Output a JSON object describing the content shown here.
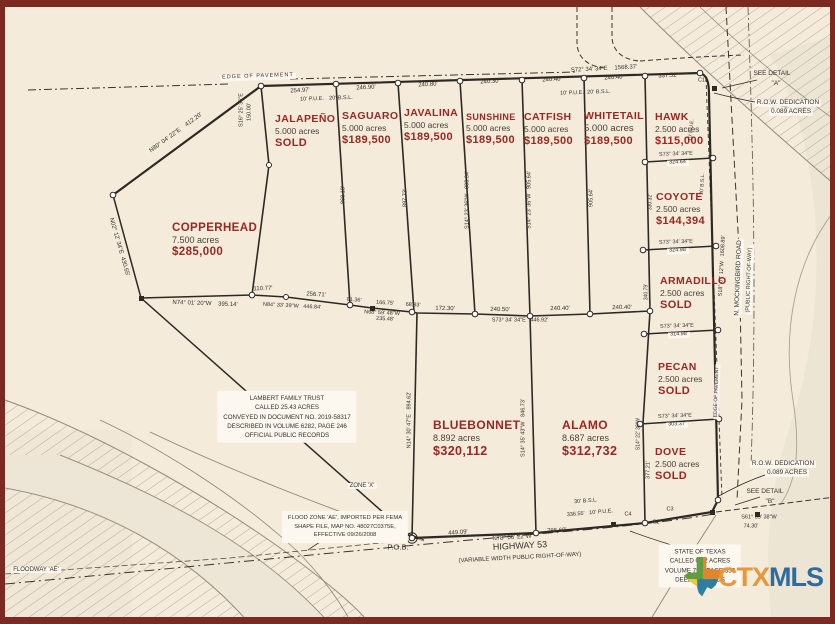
{
  "map": {
    "logo": {
      "ctx": "CTX",
      "mls": "MLS"
    },
    "colors": {
      "lot_red": "#9b2820",
      "line": "#2e2922",
      "cream": "#f4ebdb",
      "maroon_border": "#7c2a21",
      "ctx_orange": "#e8973b",
      "mls_blue": "#2f6b9d"
    },
    "lots": [
      {
        "name": "JALAPEÑO",
        "acres": "5.000 acres",
        "price": "SOLD",
        "x": 275,
        "y": 113
      },
      {
        "name": "SAGUARO",
        "acres": "5.000 acres",
        "price": "$189,500",
        "x": 342,
        "y": 110
      },
      {
        "name": "JAVALINA",
        "acres": "5.000 acres",
        "price": "$189,500",
        "x": 404,
        "y": 107
      },
      {
        "name": "SUNSHINE",
        "acres": "5.000 acres",
        "price": "$189,500",
        "x": 466,
        "y": 112,
        "ns": 9
      },
      {
        "name": "CATFISH",
        "acres": "5.000 acres",
        "price": "$189,500",
        "x": 524,
        "y": 111
      },
      {
        "name": "WHITETAIL",
        "acres": "5.000 acres",
        "price": "$189,500",
        "x": 584,
        "y": 110,
        "as": 9.5
      },
      {
        "name": "HAWK",
        "acres": "2.500 acres",
        "price": "$115,000",
        "x": 655,
        "y": 111
      },
      {
        "name": "COYOTE",
        "acres": "2.500 acres",
        "price": "$144,394",
        "x": 656,
        "y": 191
      },
      {
        "name": "ARMADILLO",
        "acres": "2.500 acres",
        "price": "SOLD",
        "x": 660,
        "y": 275
      },
      {
        "name": "PECAN",
        "acres": "2.500 acres",
        "price": "SOLD",
        "x": 658,
        "y": 361
      },
      {
        "name": "DOVE",
        "acres": "2.500 acres",
        "price": "SOLD",
        "x": 655,
        "y": 446
      },
      {
        "name": "COPPERHEAD",
        "acres": "7.500 acres",
        "price": "$285,000",
        "x": 172,
        "y": 222,
        "ns": 11.5,
        "as": 9,
        "ps": 11.5
      },
      {
        "name": "BLUEBONNET",
        "acres": "8.892 acres",
        "price": "$320,112",
        "x": 433,
        "y": 418,
        "ns": 12,
        "as": 9,
        "ps": 12.5
      },
      {
        "name": "ALAMO",
        "acres": "8.687 acres",
        "price": "$312,732",
        "x": 562,
        "y": 418,
        "ns": 12,
        "as": 9,
        "ps": 12.5
      }
    ],
    "annotations": [
      {
        "text": "EDGE OF PAVEMENT",
        "x": 258,
        "y": 77,
        "rot": -2,
        "size": 5.5,
        "bg": true,
        "ls": 1
      },
      {
        "text": "S72° 34' 34\"E    1568.37'",
        "x": 604,
        "y": 69,
        "rot": -3,
        "size": 6
      },
      {
        "text": "254.97'",
        "x": 300,
        "y": 91,
        "rot": -3,
        "size": 6
      },
      {
        "text": "10' P.U.E.",
        "x": 312,
        "y": 100,
        "rot": -2,
        "size": 5.5
      },
      {
        "text": "20' B.S.L.",
        "x": 341,
        "y": 99,
        "rot": -2,
        "size": 5.5
      },
      {
        "text": "246.90'",
        "x": 366,
        "y": 88,
        "rot": -3,
        "size": 6
      },
      {
        "text": "240.80'",
        "x": 428,
        "y": 85,
        "rot": -3,
        "size": 6
      },
      {
        "text": "240.30'",
        "x": 490,
        "y": 82,
        "rot": -3,
        "size": 6
      },
      {
        "text": "240.40'",
        "x": 552,
        "y": 80,
        "rot": -3,
        "size": 6
      },
      {
        "text": "10' P.U.E.",
        "x": 572,
        "y": 94,
        "rot": -2,
        "size": 5.5
      },
      {
        "text": "20' B.S.L.",
        "x": 599,
        "y": 93,
        "rot": -2,
        "size": 5.5
      },
      {
        "text": "240.40'",
        "x": 614,
        "y": 78,
        "rot": -3,
        "size": 6
      },
      {
        "text": "337.52'",
        "x": 668,
        "y": 76,
        "rot": -3,
        "size": 6
      },
      {
        "text": "C14",
        "x": 703,
        "y": 81,
        "size": 5.5
      },
      {
        "text": "S16° 25' 36\"E",
        "x": 242,
        "y": 110,
        "rot": -90,
        "size": 5.5
      },
      {
        "text": "150.00'",
        "x": 250,
        "y": 112,
        "rot": -90,
        "size": 5.5
      },
      {
        "text": "N80° 04' 22\"E    412.20'",
        "x": 176,
        "y": 133,
        "rot": -36,
        "size": 6
      },
      {
        "text": "SEE DETAIL",
        "x": 772,
        "y": 74,
        "size": 6.5
      },
      {
        "text": "\"A\"",
        "x": 776,
        "y": 84,
        "size": 6.5
      },
      {
        "text": "R.O.W. DEDICATION",
        "x": 788,
        "y": 103,
        "size": 6.5,
        "bg": true
      },
      {
        "text": "0.089 ACRES",
        "x": 791,
        "y": 112,
        "size": 6.5,
        "bg": true
      },
      {
        "text": "N02° 12' 34\"E  430.65'",
        "x": 119,
        "y": 247,
        "rot": 74,
        "size": 6
      },
      {
        "text": "N74° 01' 20\"W    395.14'",
        "x": 205,
        "y": 304,
        "rot": 2,
        "size": 6
      },
      {
        "text": "110.77'",
        "x": 263,
        "y": 289,
        "rot": -2,
        "size": 6
      },
      {
        "text": "256.71'",
        "x": 316,
        "y": 295,
        "rot": 3,
        "size": 6
      },
      {
        "text": "N84° 33' 39\"W   446.84'",
        "x": 292,
        "y": 307,
        "rot": 3,
        "size": 5.5
      },
      {
        "text": "81.36'",
        "x": 354,
        "y": 301,
        "rot": 4,
        "size": 5.5
      },
      {
        "text": "166.75'",
        "x": 385,
        "y": 304,
        "rot": 3,
        "size": 5.5
      },
      {
        "text": "N68° 59' 48\"W",
        "x": 382,
        "y": 314,
        "rot": 3,
        "size": 5.5
      },
      {
        "text": "235.48'",
        "x": 385,
        "y": 320,
        "rot": 3,
        "size": 5.5
      },
      {
        "text": "68.93'",
        "x": 413,
        "y": 306,
        "rot": 3,
        "size": 5.5
      },
      {
        "text": "172.30'",
        "x": 445,
        "y": 309,
        "rot": 1,
        "size": 6
      },
      {
        "text": "240.50'",
        "x": 500,
        "y": 310,
        "rot": 1,
        "size": 6
      },
      {
        "text": "S73° 34' 34\"E   446.92'",
        "x": 520,
        "y": 321,
        "size": 5.5
      },
      {
        "text": "240.40'",
        "x": 560,
        "y": 309,
        "rot": -1,
        "size": 6
      },
      {
        "text": "240.40'",
        "x": 622,
        "y": 308,
        "rot": -1,
        "size": 6
      },
      {
        "text": "868.18'",
        "x": 344,
        "y": 195,
        "rot": -90,
        "size": 5.5
      },
      {
        "text": "897.73'",
        "x": 406,
        "y": 198,
        "rot": -90,
        "size": 5.5
      },
      {
        "text": "S14° 23' 36\"W   903.64'",
        "x": 468,
        "y": 200,
        "rot": -90,
        "size": 5.5
      },
      {
        "text": "S14° 23' 36\"W   905.64'",
        "x": 530,
        "y": 200,
        "rot": -90,
        "size": 5.5
      },
      {
        "text": "905.64'",
        "x": 592,
        "y": 198,
        "rot": -90,
        "size": 5.5
      },
      {
        "text": "330.32'",
        "x": 651,
        "y": 202,
        "rot": -90,
        "size": 5
      },
      {
        "text": "340.79'",
        "x": 647,
        "y": 292,
        "rot": -90,
        "size": 5
      },
      {
        "text": "10' P.U.E.",
        "x": 692,
        "y": 130,
        "rot": -85,
        "size": 5
      },
      {
        "text": "20' B.S.L.",
        "x": 703,
        "y": 184,
        "rot": -87,
        "size": 5
      },
      {
        "text": "S18° 07' 12\"W   1608.89'",
        "x": 723,
        "y": 266,
        "rot": -87,
        "size": 5.5
      },
      {
        "text": "N. MOCKINGBIRD ROAD",
        "x": 739,
        "y": 278,
        "rot": -88,
        "size": 6.5,
        "bg": true
      },
      {
        "text": "(PUBLIC RIGHT-OF-WAY)",
        "x": 750,
        "y": 280,
        "rot": -88,
        "size": 5.5,
        "bg": true
      },
      {
        "text": "EDGE OF PAVEMENT",
        "x": 717,
        "y": 392,
        "rot": -88,
        "size": 5,
        "bg": true
      },
      {
        "text": "S73° 34' 34\"E",
        "x": 676,
        "y": 155,
        "rot": -2,
        "size": 5.5
      },
      {
        "text": "324.64'",
        "x": 678,
        "y": 163,
        "rot": -2,
        "size": 5.5,
        "bg": true
      },
      {
        "text": "S73° 34' 34\"E",
        "x": 676,
        "y": 243,
        "rot": -2,
        "size": 5.5
      },
      {
        "text": "324.98'",
        "x": 678,
        "y": 251,
        "rot": -2,
        "size": 5.5,
        "bg": true
      },
      {
        "text": "S73° 34' 34\"E",
        "x": 677,
        "y": 327,
        "rot": -2,
        "size": 5.5
      },
      {
        "text": "314.98'",
        "x": 679,
        "y": 335,
        "rot": -2,
        "size": 5.5,
        "bg": true
      },
      {
        "text": "S73° 34' 34\"E",
        "x": 675,
        "y": 417,
        "rot": -2,
        "size": 5.5
      },
      {
        "text": "303.37'",
        "x": 677,
        "y": 425,
        "rot": -2,
        "size": 5.5,
        "bg": true
      },
      {
        "text": "S14° 22' 36\"W",
        "x": 639,
        "y": 434,
        "rot": -90,
        "size": 5
      },
      {
        "text": "377.21'",
        "x": 649,
        "y": 470,
        "rot": -90,
        "size": 5.5
      },
      {
        "text": "N14° 30' 47\"E   894.62'",
        "x": 410,
        "y": 420,
        "rot": -90,
        "size": 5.5
      },
      {
        "text": "S14° 35' 43\"W   846.73'",
        "x": 524,
        "y": 428,
        "rot": -90,
        "size": 5.5
      },
      {
        "lines": [
          "LAMBERT FAMILY TRUST",
          "CALLED 25.43 ACRES",
          "CONVEYED IN DOCUMENT NO. 2019-58317",
          "DESCRIBED IN VOLUME 6282, PAGE 246",
          "OFFICIAL PUBLIC RECORDS"
        ],
        "x": 287,
        "y": 417,
        "size": 6.2,
        "box": true
      },
      {
        "lines": [
          "FLOOD ZONE 'AE', IMPORTED PER FEMA",
          "SHAPE FILE, MAP NO. 48027C0375E,",
          "EFFECTIVE 09/26/2008"
        ],
        "x": 345,
        "y": 527,
        "size": 5.8,
        "box": true
      },
      {
        "text": "ZONE 'X'",
        "x": 362,
        "y": 486,
        "size": 6,
        "bg": true
      },
      {
        "text": "FLOODWAY 'AE'",
        "x": 36,
        "y": 570,
        "size": 6,
        "bg": true
      },
      {
        "text": "P.O.B.",
        "x": 398,
        "y": 547,
        "size": 7.5
      },
      {
        "text": "HIGHWAY 53",
        "x": 520,
        "y": 546,
        "rot": -3,
        "size": 9
      },
      {
        "text": "(VARIABLE WIDTH PUBLIC RIGHT-OF-WAY)",
        "x": 520,
        "y": 558,
        "rot": -3,
        "size": 6
      },
      {
        "text": "449.09'",
        "x": 458,
        "y": 533,
        "rot": -4,
        "size": 6
      },
      {
        "text": "N78° 06' 22\"W",
        "x": 512,
        "y": 538,
        "rot": -4,
        "size": 6
      },
      {
        "text": "785.60'",
        "x": 557,
        "y": 531,
        "rot": -4,
        "size": 6
      },
      {
        "text": "30' B.S.L.",
        "x": 586,
        "y": 502,
        "rot": -5,
        "size": 5.5
      },
      {
        "text": "336.55'   10' P.U.E.",
        "x": 590,
        "y": 514,
        "rot": -5,
        "size": 5.5
      },
      {
        "text": "C4",
        "x": 628,
        "y": 515,
        "size": 5.5
      },
      {
        "text": "C3",
        "x": 670,
        "y": 510,
        "size": 5.5
      },
      {
        "text": "C2",
        "x": 656,
        "y": 523,
        "size": 5.5
      },
      {
        "text": "S61° 39' 38\"W",
        "x": 759,
        "y": 518,
        "size": 5.5
      },
      {
        "text": "74.30'",
        "x": 751,
        "y": 527,
        "size": 5.5
      },
      {
        "text": "R.O.W. DEDICATION",
        "x": 783,
        "y": 464,
        "size": 6.5,
        "bg": true
      },
      {
        "text": "0.089 ACRES",
        "x": 787,
        "y": 473,
        "size": 6.5,
        "bg": true
      },
      {
        "text": "SEE DETAIL",
        "x": 765,
        "y": 492,
        "size": 6.5
      },
      {
        "text": "\"B\"",
        "x": 770,
        "y": 502,
        "size": 6.5
      },
      {
        "lines": [
          "STATE OF TEXAS",
          "CALLED 0.62  ACRES",
          "VOLUME 799, PAGE 533",
          "DEED RECORDS"
        ],
        "x": 700,
        "y": 566,
        "size": 6.2,
        "box": true
      }
    ]
  }
}
